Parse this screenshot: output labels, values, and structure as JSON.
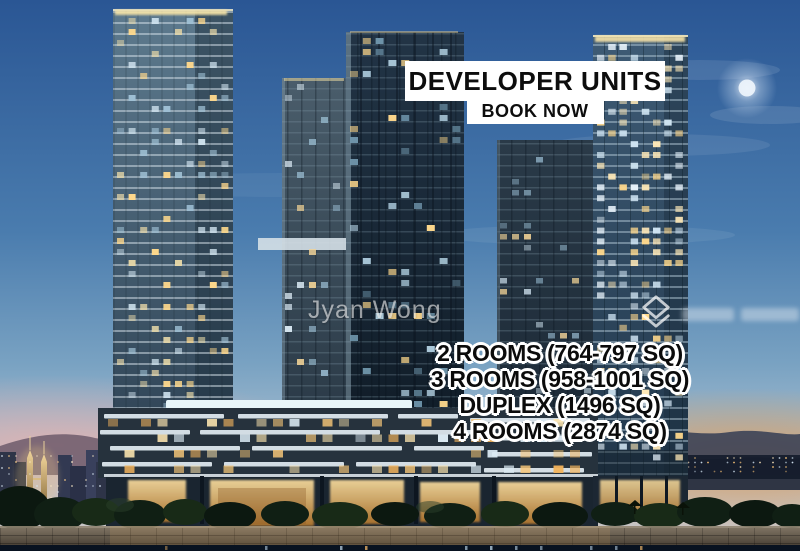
{
  "image": {
    "type": "property-listing-photo",
    "scene": "Three glass residential towers above a lit retail podium at dusk, waterfront promenade and seawall in the foreground, Kuala Lumpur skyline with the Petronas Twin Towers at lower left, mountains and city lights at lower right, bright moon in a blue evening sky"
  },
  "banner": {
    "title": "DEVELOPER UNITS",
    "subtitle": "BOOK NOW",
    "bg_color": "#ffffff",
    "text_color": "#0d0d0d"
  },
  "unit_list": {
    "items": [
      "2 ROOMS (764-797 SQ)",
      "3 ROOMS (958-1001 SQ)",
      "DUPLEX (1496 SQ)",
      "4 ROOMS (2874 SQ)"
    ],
    "text_color": "#0b0b0b",
    "outline_color": "#ffffff"
  },
  "watermarks": {
    "agent_name": "Jyan Wong",
    "logo_icon": "stacked-chevrons-icon",
    "logo_text_legible": false
  },
  "palette": {
    "sky_top": "#2a5694",
    "sky_horizon": "#c3c6cb",
    "sunset_left_pink": "#e7b0ac",
    "sunset_right_orange": "#e29a52",
    "tower_glass": "#2e4a63",
    "window_warm": "#f6c678",
    "window_cool": "#dcebf4",
    "podium_band": "#dde7ed",
    "water": "#081220"
  }
}
